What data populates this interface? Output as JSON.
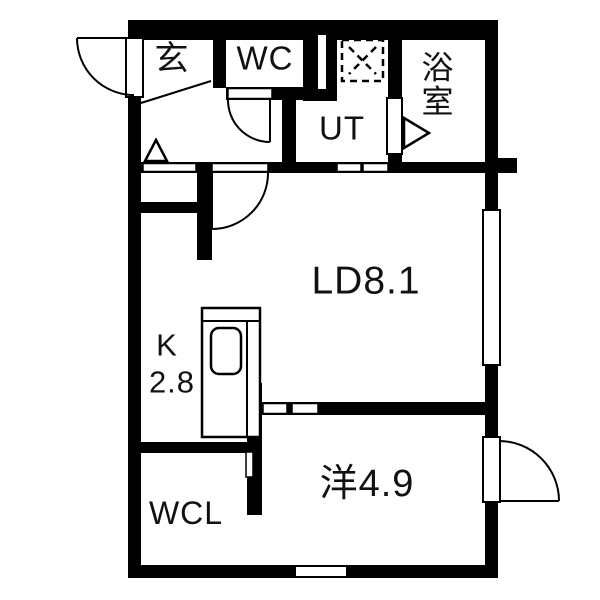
{
  "plan": {
    "title": "apartment-floor-plan",
    "colors": {
      "wall": "#000000",
      "background": "#ffffff",
      "text": "#111111"
    },
    "rooms": {
      "genkan": {
        "label": "玄"
      },
      "wc": {
        "label": "WC"
      },
      "ut": {
        "label": "UT"
      },
      "bathroom": {
        "label": "浴室",
        "chars": [
          "浴",
          "室"
        ]
      },
      "living_dining": {
        "label": "LD8.1"
      },
      "kitchen": {
        "label_letter": "K",
        "label_size": "2.8"
      },
      "wcl": {
        "label": "WCL"
      },
      "western_room": {
        "label": "洋4.9"
      }
    }
  }
}
